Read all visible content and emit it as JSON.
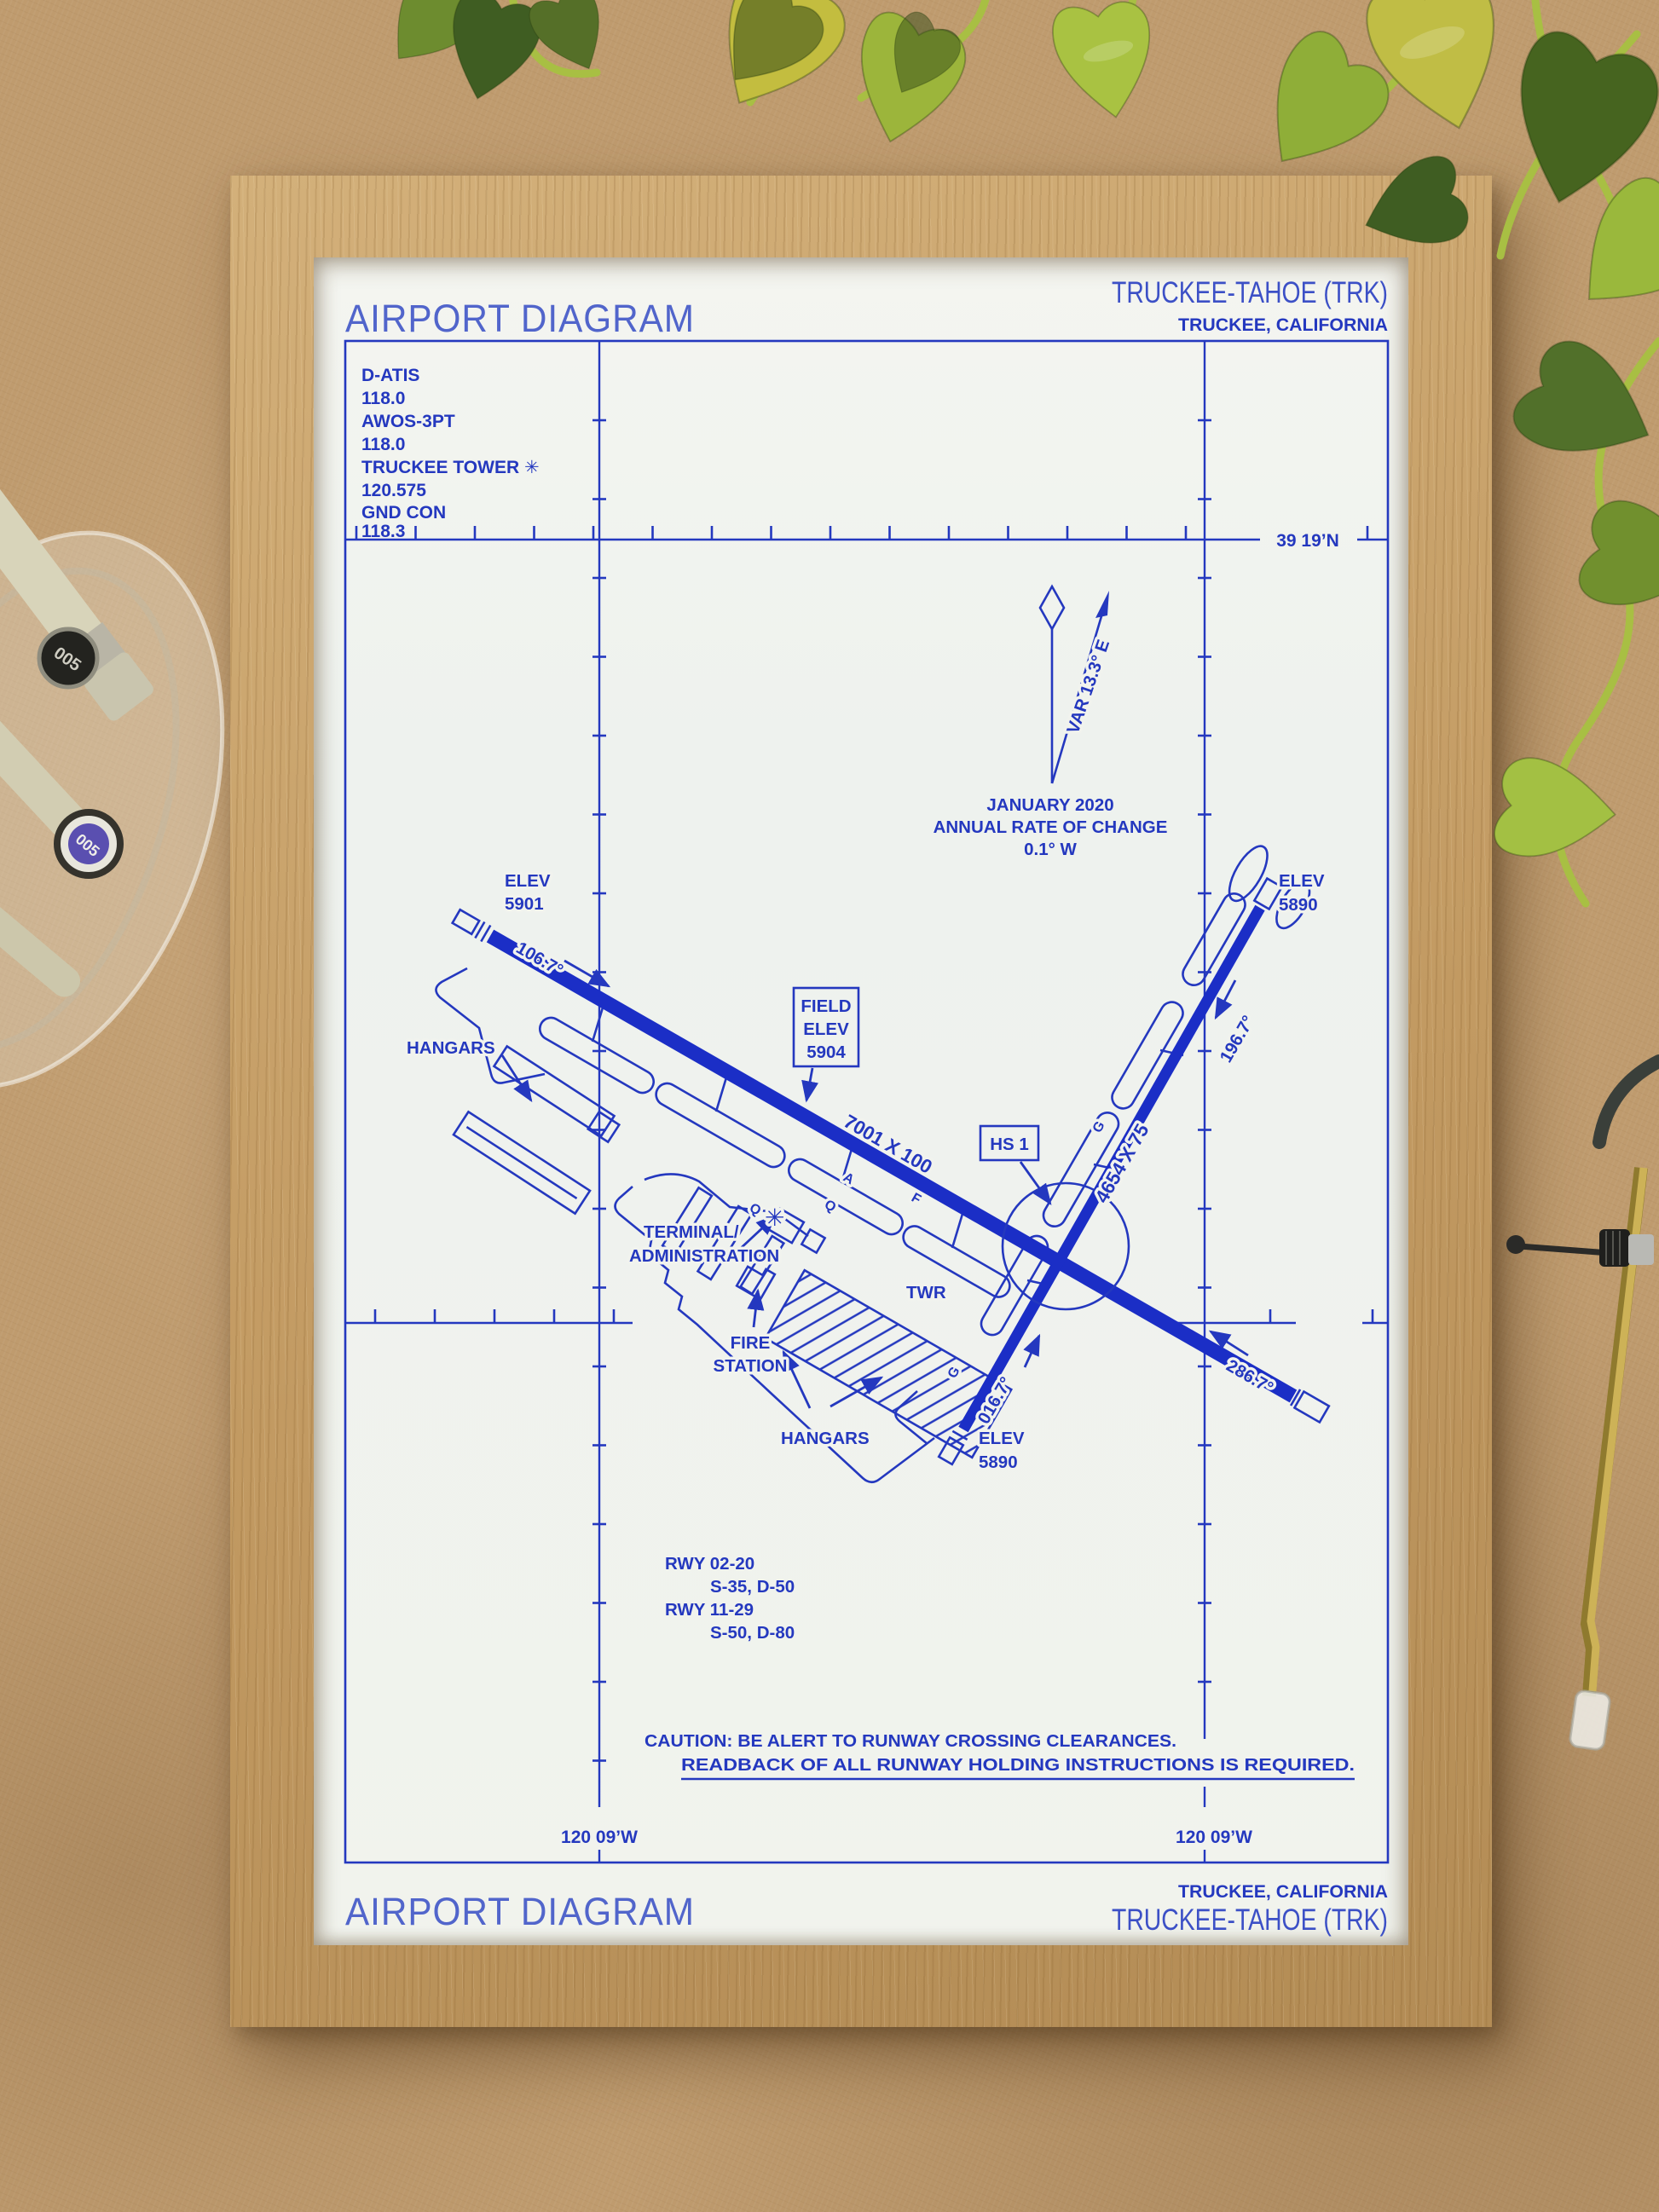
{
  "colors": {
    "ink": "#2438bf",
    "ink_strong": "#1b2ec6",
    "ink_light": "#5165cb",
    "paper": "#f1f3ee",
    "frame_wood": "#c4a06a",
    "background_cork": "#bf9b6e",
    "leaf_green_dark": "#3f5d22",
    "leaf_green_light": "#a3c043"
  },
  "header": {
    "title": "AIRPORT DIAGRAM",
    "airport": "TRUCKEE-TAHOE (TRK)",
    "city": "TRUCKEE, CALIFORNIA"
  },
  "comm": {
    "l1": "D-ATIS",
    "l2": "118.0",
    "l3": "AWOS-3PT",
    "l4": "118.0",
    "l5": "TRUCKEE TOWER ✳",
    "l6": "120.575",
    "l7": "GND CON",
    "l8": "118.3"
  },
  "graticule": {
    "lat": "39 19’N",
    "lon_left": "120 09’W",
    "lon_right": "120 09’W"
  },
  "magvar": {
    "variation": "VAR 13.3° E",
    "date": "JANUARY 2020",
    "rate_label": "ANNUAL RATE OF CHANGE",
    "rate_value": "0.1° W"
  },
  "field_elev": {
    "l1": "FIELD",
    "l2": "ELEV",
    "l3": "5904"
  },
  "hotspot_label": "HS 1",
  "rwy1129": {
    "dim": "7001 X 100",
    "hdg11": "106.7°",
    "hdg29": "286.7°",
    "elev11a": "ELEV",
    "elev11b": "5901"
  },
  "rwy0220": {
    "dim": "4654 X 75",
    "hdg02": "016.7°",
    "hdg20": "196.7°",
    "elev20a": "ELEV",
    "elev20b": "5890",
    "elev02a": "ELEV",
    "elev02b": "5890"
  },
  "labels": {
    "hangars_left": "HANGARS",
    "hangars_bottom": "HANGARS",
    "terminal1": "TERMINAL/",
    "terminal2": "ADMINISTRATION",
    "twr": "TWR",
    "fire1": "FIRE",
    "fire2": "STATION",
    "beacon": "✳"
  },
  "taxiways": {
    "t1": "Q",
    "t2": "A",
    "t3": "F",
    "t4": "Q",
    "t5": "G",
    "t6": "G"
  },
  "rwy_data": {
    "r1": "RWY 02-20",
    "r1v": "S-35, D-50",
    "r2": "RWY 11-29",
    "r2v": "S-50, D-80"
  },
  "caution": {
    "line1": "CAUTION: BE ALERT TO RUNWAY CROSSING CLEARANCES.",
    "line2": "READBACK OF ALL RUNWAY HOLDING INSTRUCTIONS IS REQUIRED."
  },
  "footer": {
    "city": "TRUCKEE, CALIFORNIA",
    "airport": "TRUCKEE-TAHOE (TRK)",
    "title": "AIRPORT DIAGRAM"
  },
  "desk_items": {
    "pen_cap_label_top": "005",
    "pen_cap_label_bottom": "005"
  }
}
